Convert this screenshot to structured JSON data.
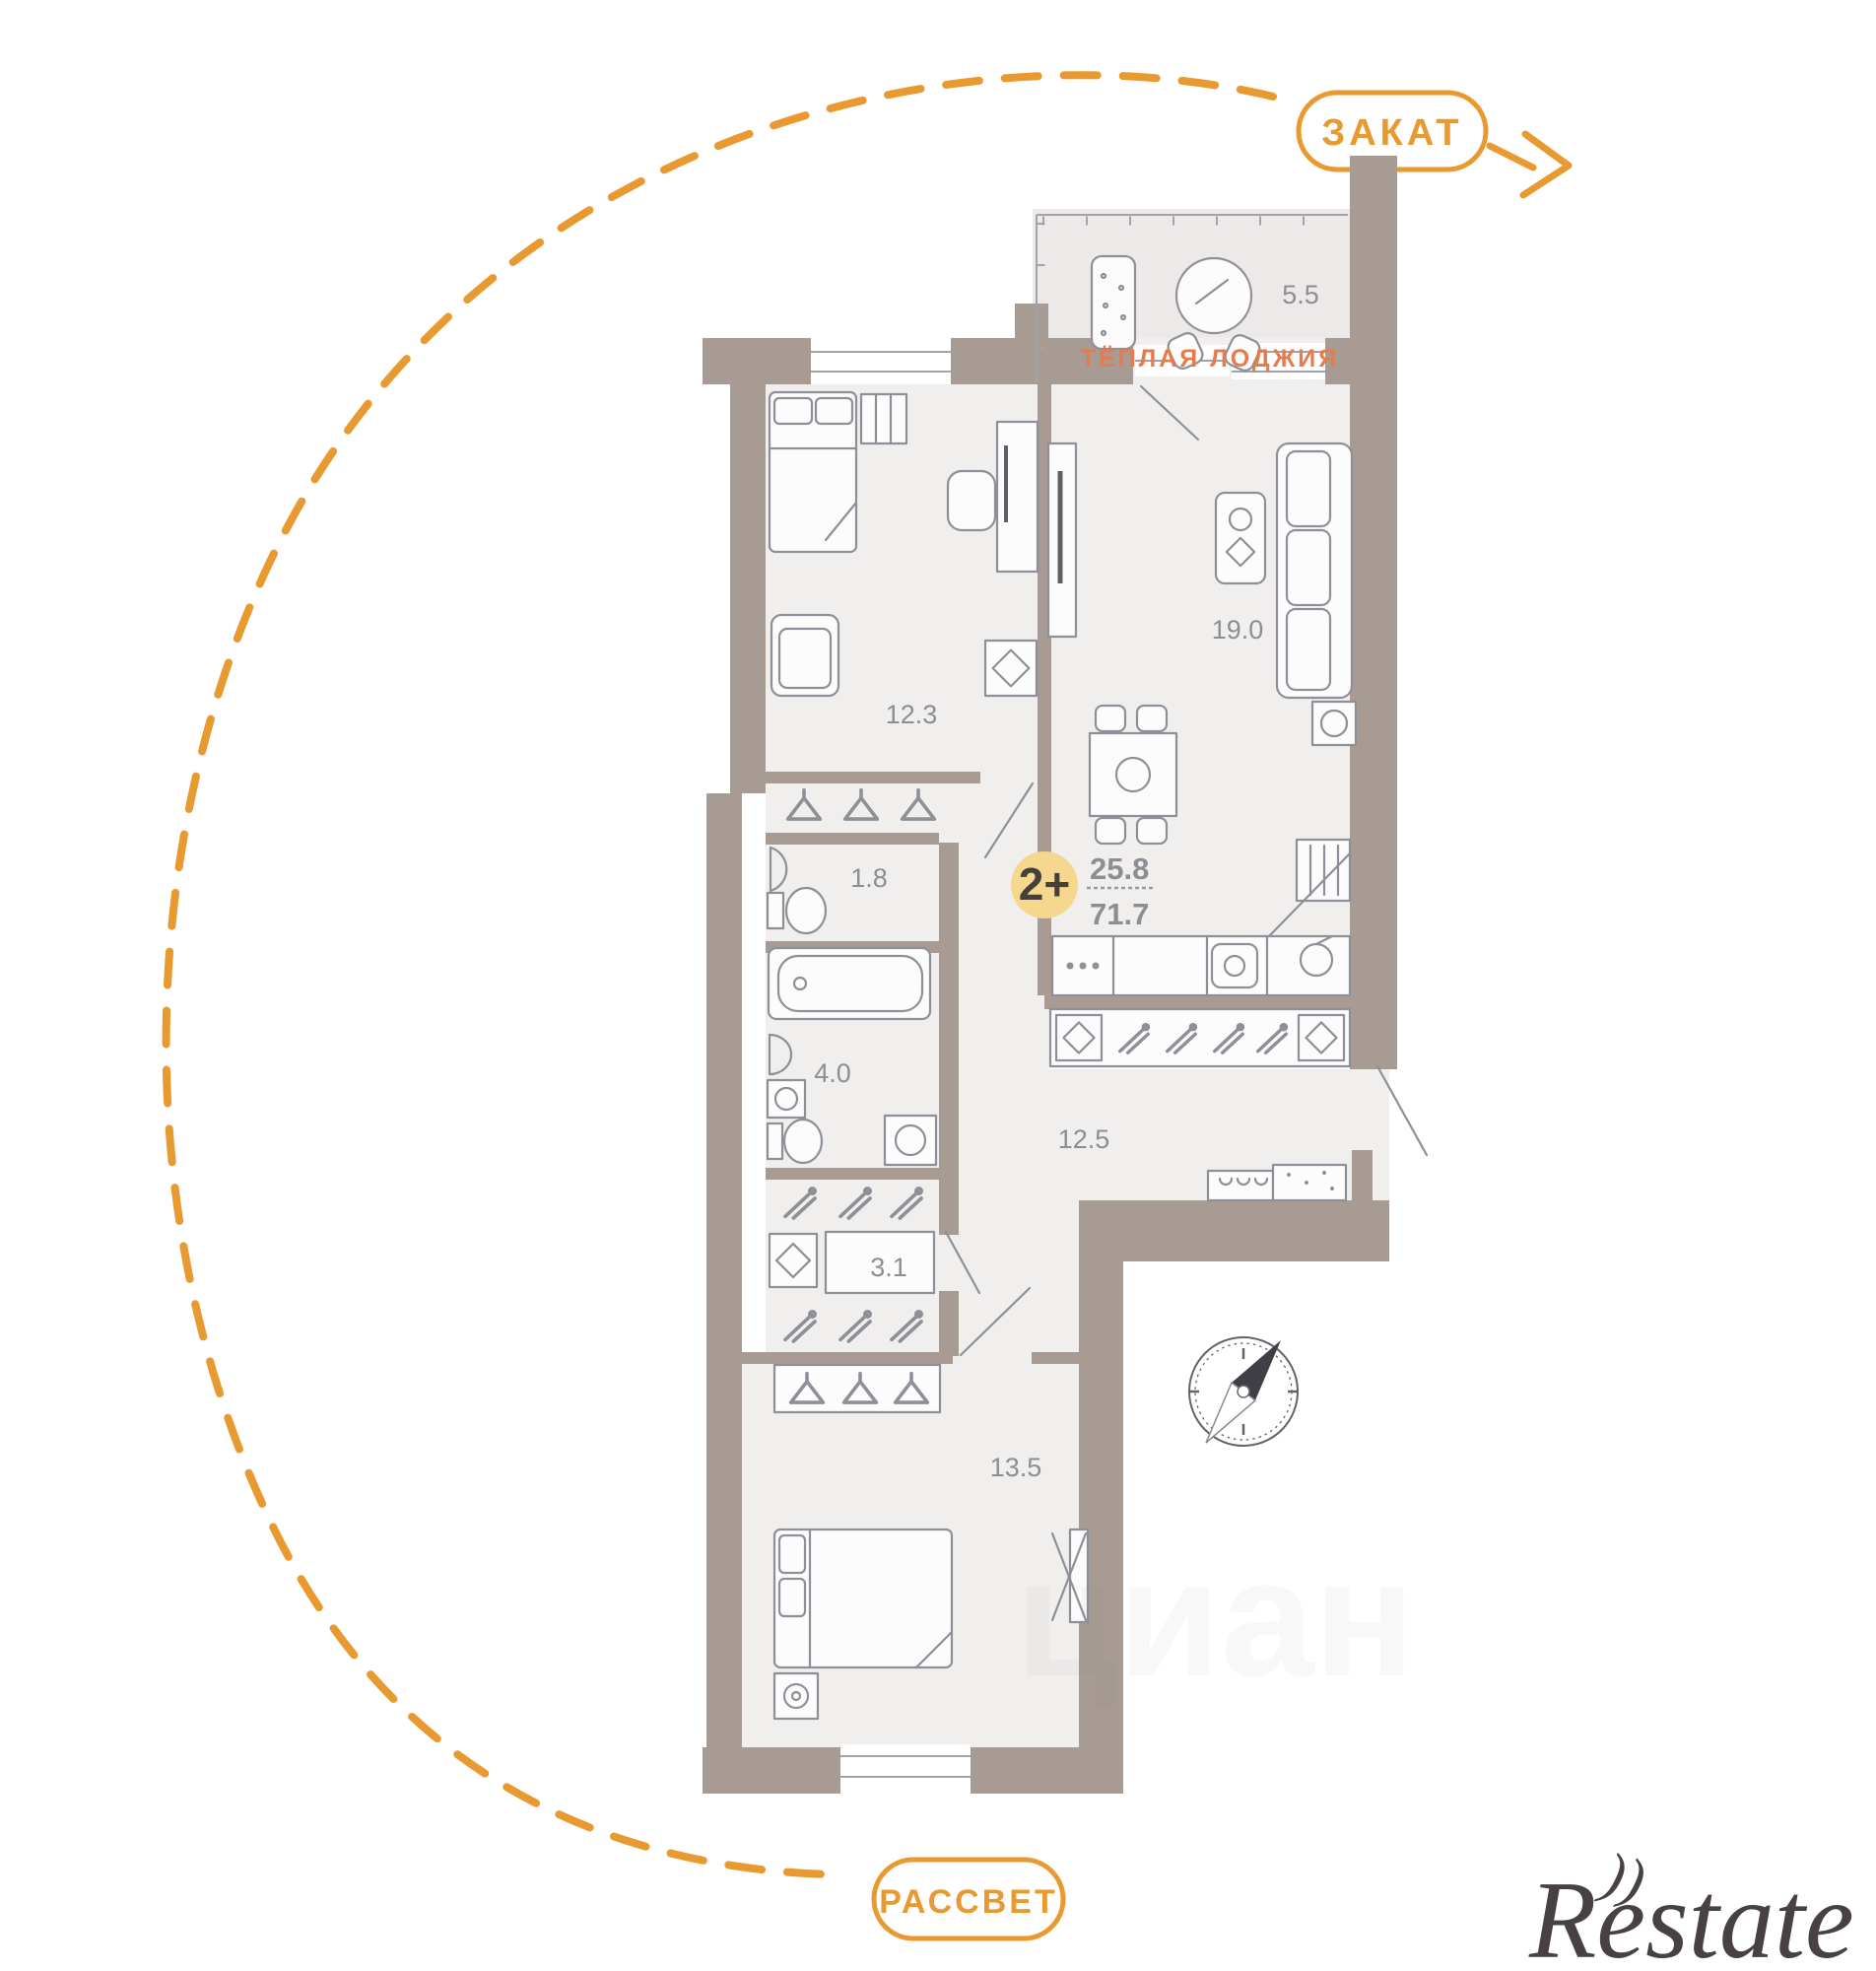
{
  "theme": {
    "accent_orange": "#E8992F",
    "wall": "#A79B93",
    "floor": "#F1EFEE",
    "loggia_floor": "#ECE9E8",
    "furniture_line": "#8F8F97",
    "label_gray": "#8D8D93",
    "loggia_text": "#E87A4C",
    "badge_fill": "#F6D78E",
    "badge_text": "#454039",
    "watermark": "#474044"
  },
  "plan": {
    "labels": {
      "sunset": "ЗАКАТ",
      "sunrise": "РАССВЕТ",
      "warm_loggia": "ТЁПЛАЯ ЛОДЖИЯ"
    },
    "badge": {
      "label": "2+",
      "living_area": "25.8",
      "total_area": "71.7"
    },
    "rooms": {
      "loggia": {
        "area": "5.5"
      },
      "bedroom": {
        "area": "12.3"
      },
      "living": {
        "area": "19.0"
      },
      "wc": {
        "area": "1.8"
      },
      "bathroom": {
        "area": "4.0"
      },
      "hallway": {
        "area": "12.5"
      },
      "wardrobe": {
        "area": "3.1"
      },
      "bedroom2": {
        "area": "13.5"
      }
    }
  },
  "watermarks": {
    "brand": "Restate",
    "portal": "циан"
  }
}
